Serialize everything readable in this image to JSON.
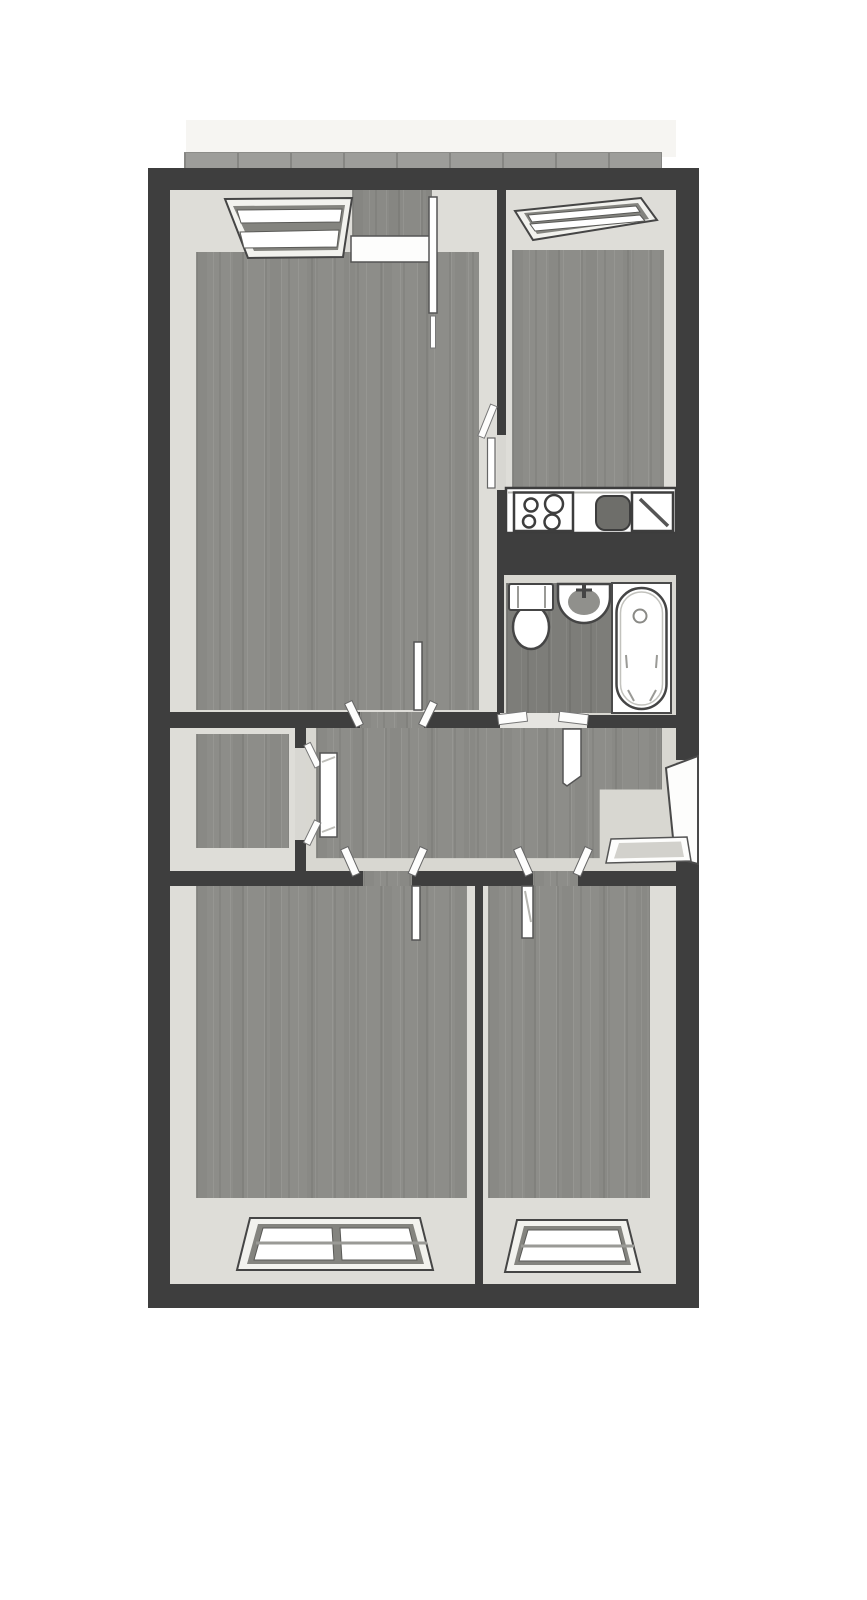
{
  "page": {
    "background": "#ffffff",
    "title": "apartment-floor-plan"
  },
  "palette": {
    "wall": "#3e3e3e",
    "wall_face_light": "#deddd8",
    "wall_face_dim": "#d8d7d1",
    "floor_wood": "#8d8d89",
    "floor_wood_dark": "#7d7d79",
    "roof_strip": "#f6f5f2",
    "balcony_railing": "#9d9d9a",
    "fixture_fill": "#ffffff",
    "fixture_outline": "#454545",
    "sink_basin_dark": "#6e6e6a"
  },
  "floorplan": {
    "rooms": [
      {
        "id": "living-room",
        "label": "living-room"
      },
      {
        "id": "kitchen",
        "label": "kitchen"
      },
      {
        "id": "bathroom",
        "label": "bathroom"
      },
      {
        "id": "closet",
        "label": "closet"
      },
      {
        "id": "hallway",
        "label": "hallway"
      },
      {
        "id": "bedroom-left",
        "label": "bedroom-left"
      },
      {
        "id": "bedroom-right",
        "label": "bedroom-right"
      },
      {
        "id": "balcony",
        "label": "balcony-strip"
      }
    ],
    "fixtures": [
      {
        "id": "living-window",
        "label": "window"
      },
      {
        "id": "balcony-door",
        "label": "balcony-door"
      },
      {
        "id": "kitchen-window",
        "label": "window"
      },
      {
        "id": "kitchen-counter",
        "label": "counter"
      },
      {
        "id": "cooktop",
        "label": "cooktop-4-burners"
      },
      {
        "id": "kitchen-basin",
        "label": "basin"
      },
      {
        "id": "kitchen-sink",
        "label": "sink"
      },
      {
        "id": "toilet",
        "label": "toilet"
      },
      {
        "id": "washbasin",
        "label": "washbasin"
      },
      {
        "id": "bathtub",
        "label": "bathtub"
      },
      {
        "id": "entrance-door",
        "label": "entrance-door"
      },
      {
        "id": "doormat",
        "label": "doormat"
      },
      {
        "id": "bedroom-left-window",
        "label": "double-window"
      },
      {
        "id": "bedroom-right-window",
        "label": "window"
      }
    ]
  }
}
